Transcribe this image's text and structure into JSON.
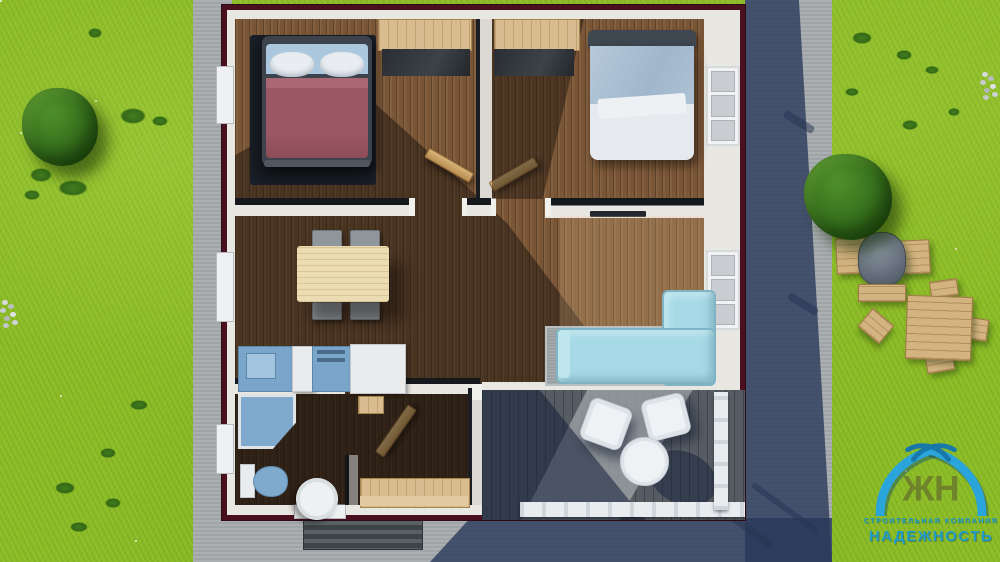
{
  "watermark": {
    "monogram": "ЖН",
    "tagline": "СТРОИТЕЛЬНАЯ КОМПАНИЯ",
    "brand": "НАДЕЖНОСТЬ",
    "brand_color": "#1b9ad2"
  },
  "palette": {
    "grass": "#8cbc26",
    "tree": "#2f6b1b",
    "concrete_path": "#a6abad",
    "cast_shadow": "#2c3d5e",
    "roof_trim": "#4a1020",
    "wall_white": "#e9e7e2",
    "floor_wood": "#7a5636",
    "floor_light_oak": "#a87d50",
    "rug_dark": "#14171c",
    "bed1_blanket": "#9b5764",
    "bed2_blanket": "#a9bed2",
    "bedding_white": "#e8ecf0",
    "sofa_cyan": "#a7d9e6",
    "rug_gray": "#9aa0a3",
    "kitchen_blue": "#7ba6cb",
    "appliance_white": "#e9ebed",
    "fixture_blue": "#7fa9cd",
    "door_wood": "#c8a265",
    "terrace_deck": "#6b7176",
    "railing_white": "#e8ecef",
    "grill_dome": "#6e7884",
    "garden_wood": "#d3b37f"
  },
  "scene": {
    "type": "top-down 3D render of a single-storey house floor plan",
    "rooms": [
      {
        "name": "bedroom-1",
        "furniture": [
          "double-bed",
          "dark-rug",
          "wardrobe"
        ]
      },
      {
        "name": "bedroom-2",
        "furniture": [
          "double-bed",
          "wardrobe"
        ]
      },
      {
        "name": "kitchen-dining",
        "furniture": [
          "dining-table",
          "four-chairs",
          "sink-counter",
          "stove",
          "fridge"
        ]
      },
      {
        "name": "living-room",
        "furniture": [
          "corner-sofa",
          "gray-rug",
          "wall-tv"
        ]
      },
      {
        "name": "bathroom",
        "furniture": [
          "corner-shower",
          "toilet",
          "round-sink"
        ]
      },
      {
        "name": "entry-hall",
        "furniture": [
          "wood-cabinet"
        ]
      },
      {
        "name": "terrace",
        "furniture": [
          "armchair",
          "armchair",
          "round-table",
          "railing"
        ]
      }
    ],
    "garden": [
      "tree",
      "tree",
      "bushes",
      "rocks",
      "bbq-grill",
      "picnic-table",
      "stools",
      "concrete-path",
      "entry-steps"
    ]
  }
}
